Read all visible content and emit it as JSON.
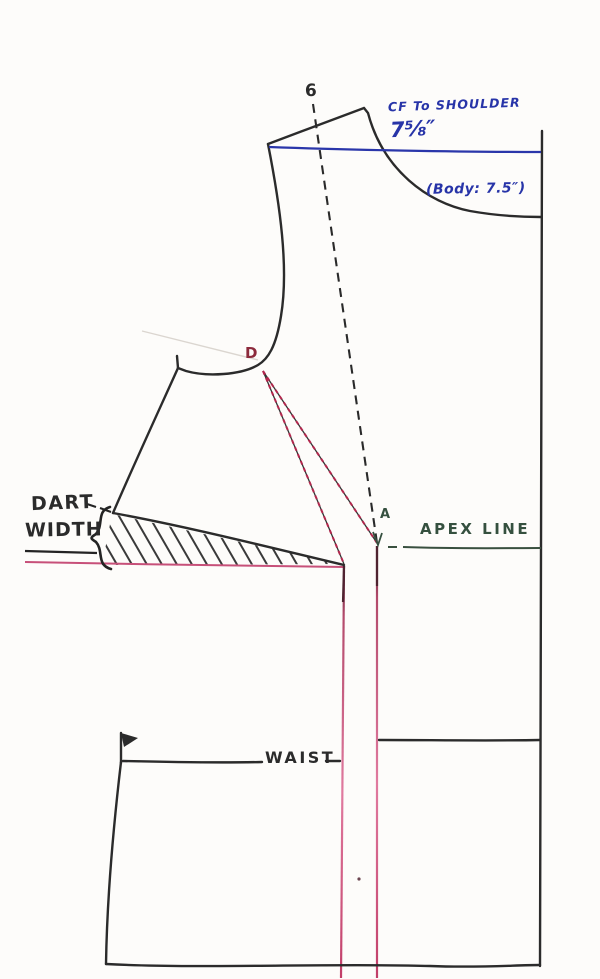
{
  "diagram": {
    "type": "hand-drawn sewing pattern draft — front bodice with bust dart",
    "background": "#fdfcfa",
    "colors": {
      "ink": "#2b2b2b",
      "annotation_blue": "#2734a8",
      "dart_red": "#b2274d",
      "dart_pink": "#d96a92",
      "apex_green": "#35503f"
    },
    "labels": {
      "point_6": "6",
      "cf_to_shoulder": "CF To SHOULDER",
      "cf_measurement": "7⅝″",
      "body_measurement": "(Body: 7.5″)",
      "point_d": "D",
      "point_a": "A",
      "apex_line": "APEX LINE",
      "dart_width_line1": "DART",
      "dart_width_line2": "WIDTH",
      "waist": "WAIST"
    }
  }
}
